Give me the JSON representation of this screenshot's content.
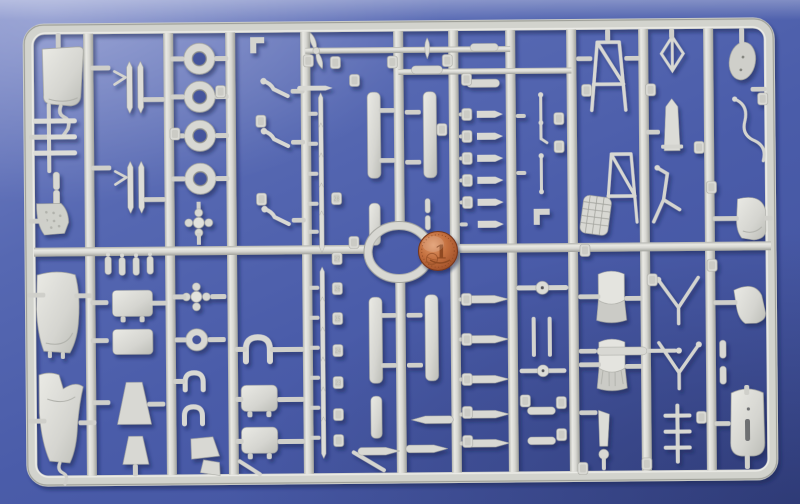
{
  "scene": {
    "type": "photograph",
    "subject": "Light grey injection-moulded model kit sprue (parts tree) laid on a blue background, photographed from above",
    "notable_parts": "engine cowlings, fuselage panels, wheels, struts, seats, landing gear legs, central oval ring",
    "scale_reference": "copper coin resting on the central ring part"
  },
  "colors": {
    "background_blue": "#4c5fab",
    "plastic_grey": "#d8d8d3",
    "plastic_highlight": "#ebebe6",
    "plastic_shadow": "#a9aaa4",
    "cast_shadow": "#141f4d",
    "coin_copper": "#c4703f",
    "coin_rim": "#8a4423"
  },
  "coin": {
    "denomination": "1",
    "description": "1 euro cent coin, obverse with large numeral 1"
  },
  "part_tags": {
    "legible_numbers": [
      "28",
      "27",
      "26",
      "25",
      "24",
      "23"
    ]
  }
}
